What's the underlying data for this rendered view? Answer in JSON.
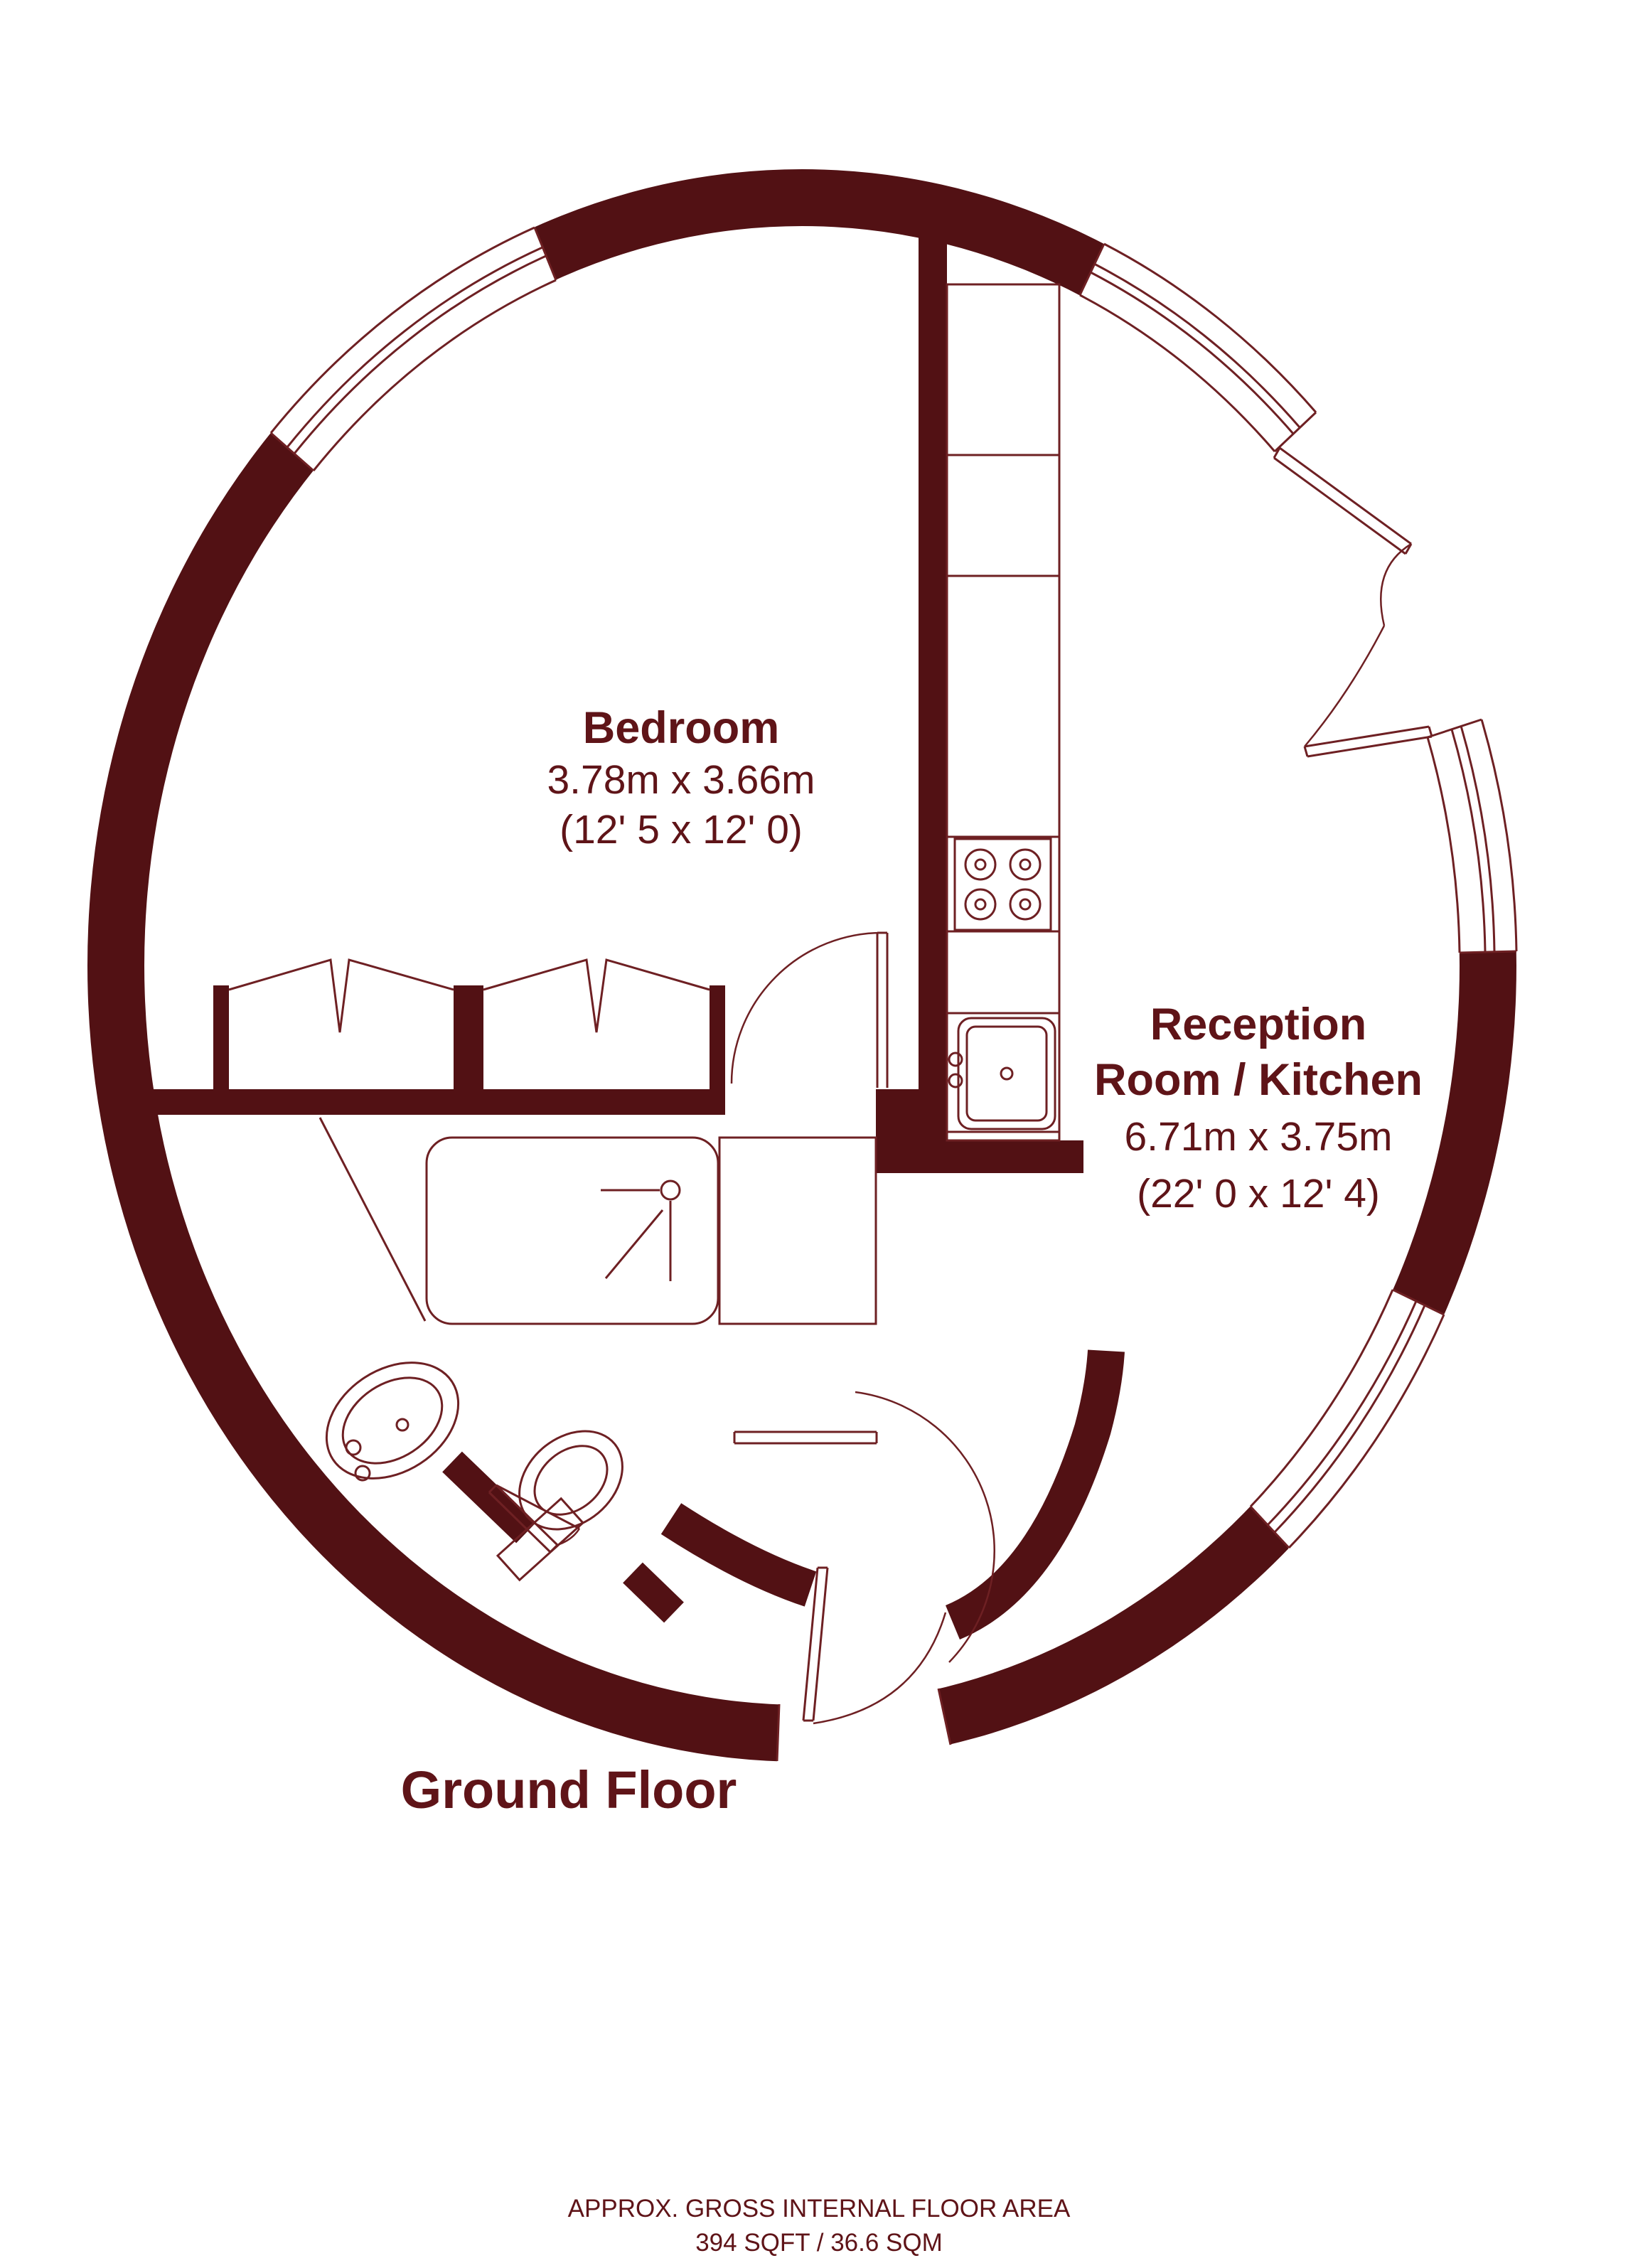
{
  "plan": {
    "floor_label": "Ground Floor",
    "rooms": {
      "bedroom": {
        "name": "Bedroom",
        "dimensions_metric": "3.78m x 3.66m",
        "dimensions_imperial": "(12' 5 x 12' 0)"
      },
      "reception": {
        "name_line1": "Reception",
        "name_line2": "Room / Kitchen",
        "dimensions_metric": "6.71m x 3.75m",
        "dimensions_imperial": "(22' 0 x 12' 4)"
      }
    },
    "footer": {
      "line1": "APPROX. GROSS INTERNAL FLOOR AREA",
      "line2": "394 SQFT / 36.6 SQM"
    },
    "fixtures": [
      "hob-icon",
      "sink-icon",
      "shower-icon",
      "basin-icon",
      "toilet-icon",
      "wardrobe-icon",
      "door-swing-icon",
      "window-icon"
    ],
    "colors": {
      "wall": "#521114",
      "line": "#6e2023",
      "text": "#5f1418",
      "bg": "#ffffff"
    }
  }
}
